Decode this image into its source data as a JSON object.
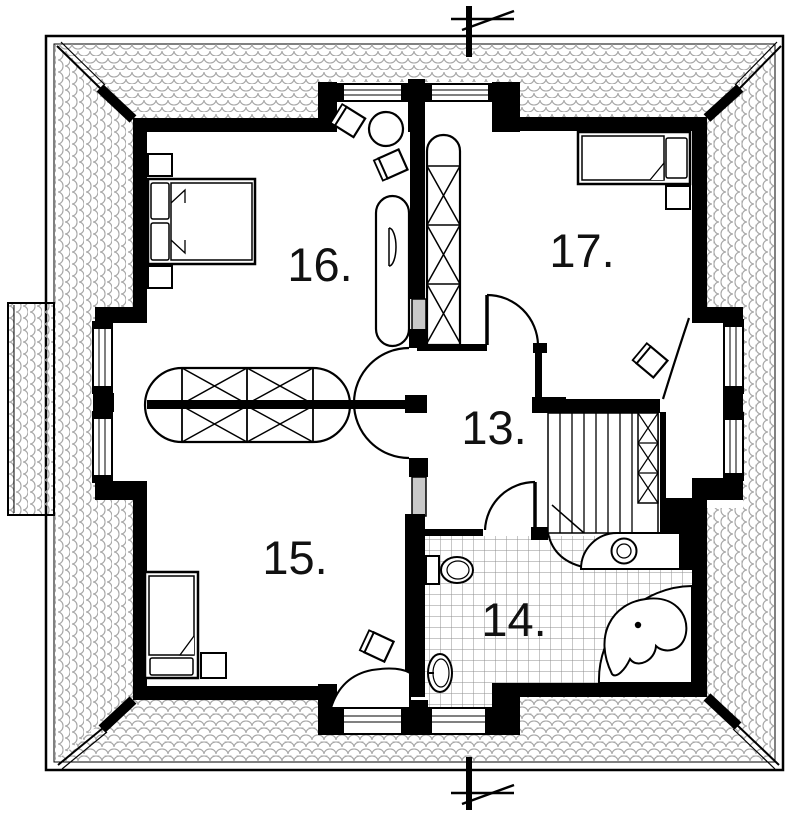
{
  "plan": {
    "kind": "floor-plan-upper-storey",
    "rooms": [
      {
        "id": "16",
        "label": "16."
      },
      {
        "id": "17",
        "label": "17."
      },
      {
        "id": "13",
        "label": "13."
      },
      {
        "id": "15",
        "label": "15."
      },
      {
        "id": "14",
        "label": "14."
      }
    ],
    "fixture_icons": [
      "double-bed-icon",
      "single-bed-icon",
      "nightstand-icon",
      "wardrobe-x-icon",
      "desk-chair-icon",
      "side-chair-icon",
      "cabinet-icon",
      "bench-icon",
      "staircase-icon",
      "toilet-icon",
      "washbasin-icon",
      "vanity-sink-icon",
      "corner-bathtub-icon",
      "window-icon",
      "door-swing-icon",
      "section-marker-icon",
      "roof-shingle-border-icon",
      "hip-ridge-icon"
    ],
    "colors": {
      "wall": "#000000",
      "background": "#ffffff",
      "roof_pattern_line": "#a6a6a6",
      "tile_line": "#8f8f8f",
      "door_panel": "#c9c9c9",
      "text": "#111111"
    }
  }
}
